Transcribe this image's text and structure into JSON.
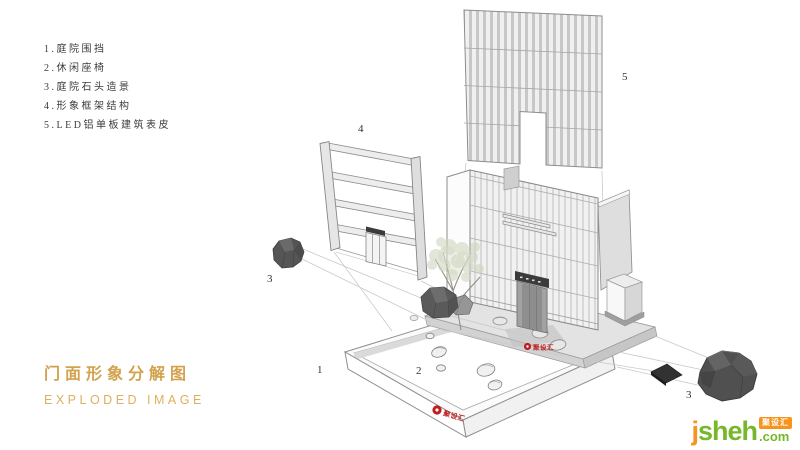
{
  "legend": {
    "items": [
      {
        "label": "1.庭院围挡"
      },
      {
        "label": "2.休闲座椅"
      },
      {
        "label": "3.庭院石头造景"
      },
      {
        "label": "4.形象框架结构"
      },
      {
        "label": "5.LED铝单板建筑表皮"
      }
    ]
  },
  "title": {
    "cn": "门面形象分解图",
    "en": "EXPLODED IMAGE"
  },
  "callouts": {
    "platform": "1",
    "seats": "2",
    "rock_left": "3",
    "rock_right": "3",
    "frame": "4",
    "skin": "5"
  },
  "watermark": {
    "brand": "聚设汇"
  },
  "logo": {
    "prefix": "j",
    "rest": "sheh",
    "badge": "聚设汇",
    "tld": ".com"
  },
  "colors": {
    "title_gold": "#d2a24c",
    "title_gold_light": "#ddb05e",
    "logo_orange": "#f7941e",
    "logo_green": "#76b82a",
    "brand_red": "#bf1e1e"
  }
}
